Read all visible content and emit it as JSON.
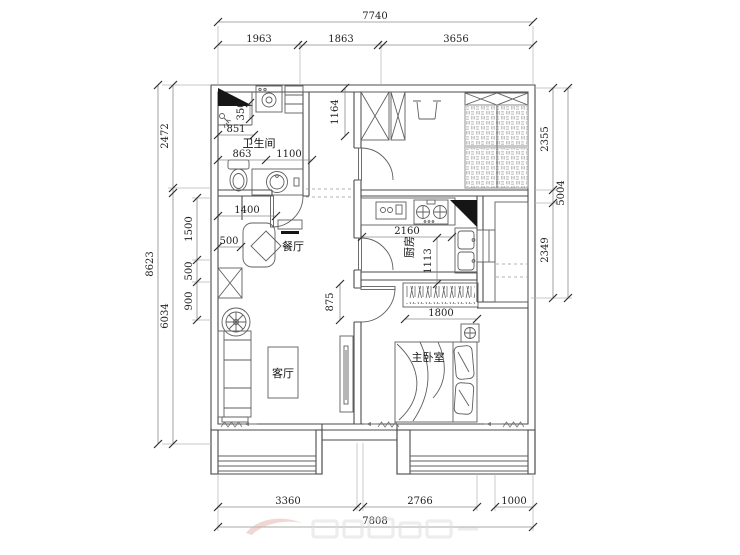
{
  "document": {
    "type": "floor-plan-drawing",
    "background": "#ffffff"
  },
  "rooms": {
    "bathroom": "卫生间",
    "dining": "餐厅",
    "kitchen": "厨房",
    "living": "客厅",
    "master_bedroom": "主卧室"
  },
  "dims": {
    "top_total": "7740",
    "top_seg1": "1963",
    "top_seg2": "1863",
    "top_seg3": "3656",
    "left_total": "8623",
    "left_seg1": "2472",
    "left_seg2": "6034",
    "hall_chain1": "1500",
    "hall_chain2": "500",
    "hall_chain3": "900",
    "right_total": "5004",
    "right_seg1": "2355",
    "right_seg2": "2349",
    "bottom_seg1": "3360",
    "bottom_seg2": "2766",
    "bottom_seg3": "1000",
    "bottom_total": "7808",
    "bath_niche": "350",
    "bath_851": "851",
    "bath_863": "863",
    "bath_door": "1100",
    "hall_width": "1400",
    "dining_niche": "500",
    "closet_depth": "1164",
    "kitchen_width": "2160",
    "kitchen_depth": "1113",
    "bedroom_door": "875",
    "wardrobe_width": "1800"
  },
  "symbols": [
    "flue-duct",
    "washing-machine",
    "shower",
    "toilet",
    "vanity-sink",
    "door-swing",
    "dining-table",
    "chair",
    "wall-console",
    "storage-cabinet",
    "decor-fan",
    "sofa",
    "coffee-table",
    "tv-cabinet",
    "gas-stove",
    "small-appliance",
    "kitchen-sink",
    "fridge-cabinet",
    "shelf",
    "wardrobe-x",
    "entry-bench",
    "tatami-bed",
    "clothes-rail",
    "double-bed",
    "pillow",
    "nightstand-plant",
    "window",
    "curtain",
    "watermark"
  ],
  "colors": {
    "wall_line": "#4b4b4b",
    "furniture_line": "#5f5f5f",
    "dim_line": "#8c8c8c",
    "tick": "#2f2f2f",
    "text": "#1f1f1f",
    "ext_line": "#b5b5b5",
    "black_fill": "#151515",
    "hatch_line": "#a0a0a0",
    "watermark_gray": "#dcdcdc",
    "watermark_red": "#e2b0a8"
  }
}
